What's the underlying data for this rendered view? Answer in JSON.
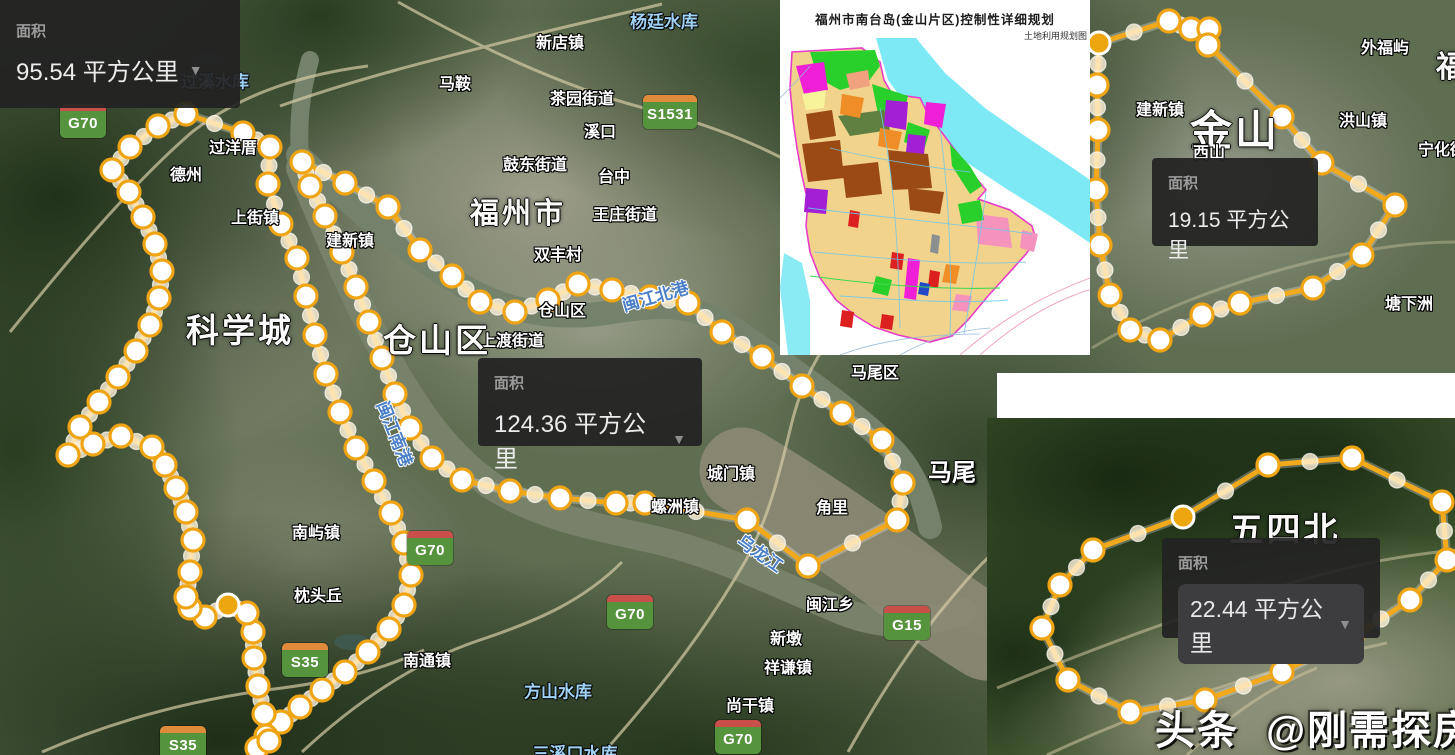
{
  "panels": {
    "p1": {
      "label": "面积",
      "value": "95.54 平方公里",
      "caret": "▼"
    },
    "p2": {
      "label": "面积",
      "value": "124.36 平方公里",
      "caret": "▼"
    },
    "p3": {
      "label": "面积",
      "value": "19.15 平方公里"
    },
    "p4": {
      "label": "面积",
      "value": "22.44 平方公里",
      "caret": "▼"
    }
  },
  "plan_inset": {
    "title": "福州市南台岛(金山片区)控制性详细规划",
    "subtitle": "土地利用规划图"
  },
  "watermark": {
    "brand": "头条",
    "handle": "@刚需探房"
  },
  "badges": [
    {
      "code": "G70",
      "k": "g",
      "x": 60,
      "y": 104
    },
    {
      "code": "S1531",
      "k": "s",
      "x": 643,
      "y": 95,
      "w": 54
    },
    {
      "code": "G70",
      "k": "g",
      "x": 407,
      "y": 531
    },
    {
      "code": "G70",
      "k": "g",
      "x": 607,
      "y": 595
    },
    {
      "code": "S35",
      "k": "s",
      "x": 282,
      "y": 643
    },
    {
      "code": "G15",
      "k": "g",
      "x": 884,
      "y": 606
    },
    {
      "code": "G70",
      "k": "g",
      "x": 715,
      "y": 720
    },
    {
      "code": "S35",
      "k": "s",
      "x": 160,
      "y": 726
    }
  ],
  "labels": [
    {
      "t": "新店镇",
      "x": 560,
      "y": 41,
      "c": "town"
    },
    {
      "t": "马鞍",
      "x": 455,
      "y": 82,
      "c": "town"
    },
    {
      "t": "茶园街道",
      "x": 582,
      "y": 97,
      "c": "town"
    },
    {
      "t": "溪口",
      "x": 600,
      "y": 130,
      "c": "town"
    },
    {
      "t": "鼓东街道",
      "x": 535,
      "y": 163,
      "c": "town"
    },
    {
      "t": "台中",
      "x": 614,
      "y": 175,
      "c": "town"
    },
    {
      "t": "福州市",
      "x": 518,
      "y": 211,
      "c": "big",
      "fs": 29
    },
    {
      "t": "王庄街道",
      "x": 625,
      "y": 213,
      "c": "town"
    },
    {
      "t": "双丰村",
      "x": 558,
      "y": 253,
      "c": "town"
    },
    {
      "t": "仓山区",
      "x": 562,
      "y": 309,
      "c": "town"
    },
    {
      "t": "上渡街道",
      "x": 512,
      "y": 339,
      "c": "town"
    },
    {
      "t": "仓山区",
      "x": 437,
      "y": 338,
      "c": "big",
      "fs": 33
    },
    {
      "t": "科学城",
      "x": 240,
      "y": 328,
      "c": "big",
      "fs": 33
    },
    {
      "t": "过洋厝",
      "x": 233,
      "y": 146,
      "c": "town"
    },
    {
      "t": "德州",
      "x": 186,
      "y": 173,
      "c": "town"
    },
    {
      "t": "上街镇",
      "x": 255,
      "y": 216,
      "c": "town"
    },
    {
      "t": "建新镇",
      "x": 350,
      "y": 239,
      "c": "town"
    },
    {
      "t": "城门镇",
      "x": 731,
      "y": 472,
      "c": "town"
    },
    {
      "t": "螺洲镇",
      "x": 675,
      "y": 505,
      "c": "town"
    },
    {
      "t": "角里",
      "x": 832,
      "y": 506,
      "c": "town"
    },
    {
      "t": "闽江乡",
      "x": 830,
      "y": 603,
      "c": "town"
    },
    {
      "t": "新墩",
      "x": 786,
      "y": 637,
      "c": "town"
    },
    {
      "t": "祥谦镇",
      "x": 788,
      "y": 666,
      "c": "town"
    },
    {
      "t": "尚干镇",
      "x": 750,
      "y": 704,
      "c": "town"
    },
    {
      "t": "南屿镇",
      "x": 316,
      "y": 531,
      "c": "town"
    },
    {
      "t": "枕头丘",
      "x": 318,
      "y": 594,
      "c": "town"
    },
    {
      "t": "南通镇",
      "x": 427,
      "y": 659,
      "c": "town"
    },
    {
      "t": "马尾区",
      "x": 875,
      "y": 371,
      "c": "town"
    },
    {
      "t": "马尾",
      "x": 952,
      "y": 470,
      "c": "mid"
    },
    {
      "t": "外福屿",
      "x": 1385,
      "y": 46,
      "c": "town"
    },
    {
      "t": "福州",
      "x": 1436,
      "y": 64,
      "c": "big",
      "fs": 30,
      "a": "left"
    },
    {
      "t": "建新镇",
      "x": 1160,
      "y": 108,
      "c": "town"
    },
    {
      "t": "金山",
      "x": 1235,
      "y": 128,
      "c": "big",
      "fs": 42
    },
    {
      "t": "西山",
      "x": 1209,
      "y": 151,
      "c": "town"
    },
    {
      "t": "洪山镇",
      "x": 1363,
      "y": 119,
      "c": "town"
    },
    {
      "t": "宁化街道",
      "x": 1418,
      "y": 148,
      "c": "town",
      "a": "left"
    },
    {
      "t": "塘下洲",
      "x": 1409,
      "y": 302,
      "c": "town"
    },
    {
      "t": "五四北",
      "x": 1285,
      "y": 527,
      "c": "big",
      "fs": 34
    },
    {
      "t": "过溪水库",
      "x": 215,
      "y": 80,
      "c": "water"
    },
    {
      "t": "杨廷水库",
      "x": 664,
      "y": 20,
      "c": "water"
    },
    {
      "t": "方山水库",
      "x": 558,
      "y": 690,
      "c": "water"
    },
    {
      "t": "三溪口水库",
      "x": 575,
      "y": 752,
      "c": "water"
    },
    {
      "t": "闽江北港",
      "x": 655,
      "y": 295,
      "c": "river",
      "r": -16
    },
    {
      "t": "闽江南港",
      "x": 396,
      "y": 433,
      "c": "river",
      "r": 68
    },
    {
      "t": "乌龙江",
      "x": 761,
      "y": 552,
      "c": "river",
      "r": 35
    }
  ],
  "polygons": [
    {
      "name": "科学城片区",
      "area": "95.54 平方公里",
      "solid": [
        30
      ],
      "points": [
        [
          186,
          114
        ],
        [
          243,
          133
        ],
        [
          270,
          147
        ],
        [
          268,
          184
        ],
        [
          281,
          224
        ],
        [
          297,
          258
        ],
        [
          306,
          296
        ],
        [
          315,
          335
        ],
        [
          326,
          374
        ],
        [
          340,
          412
        ],
        [
          356,
          448
        ],
        [
          374,
          481
        ],
        [
          391,
          513
        ],
        [
          404,
          543
        ],
        [
          411,
          575
        ],
        [
          404,
          605
        ],
        [
          389,
          629
        ],
        [
          368,
          652
        ],
        [
          345,
          672
        ],
        [
          322,
          690
        ],
        [
          300,
          707
        ],
        [
          281,
          722
        ],
        [
          266,
          736
        ],
        [
          257,
          748
        ],
        [
          269,
          741
        ],
        [
          264,
          714
        ],
        [
          258,
          686
        ],
        [
          254,
          658
        ],
        [
          253,
          632
        ],
        [
          247,
          613
        ],
        [
          228,
          605
        ],
        [
          205,
          617
        ],
        [
          190,
          608
        ],
        [
          186,
          597
        ],
        [
          190,
          572
        ],
        [
          193,
          540
        ],
        [
          186,
          512
        ],
        [
          176,
          488
        ],
        [
          165,
          465
        ],
        [
          152,
          447
        ],
        [
          121,
          436
        ],
        [
          93,
          444
        ],
        [
          68,
          455
        ],
        [
          80,
          427
        ],
        [
          99,
          402
        ],
        [
          118,
          377
        ],
        [
          136,
          351
        ],
        [
          150,
          325
        ],
        [
          159,
          298
        ],
        [
          162,
          271
        ],
        [
          155,
          244
        ],
        [
          143,
          217
        ],
        [
          129,
          192
        ],
        [
          112,
          170
        ],
        [
          130,
          147
        ],
        [
          158,
          126
        ]
      ]
    },
    {
      "name": "仓山区片区",
      "area": "124.36 平方公里",
      "solid": [],
      "points": [
        [
          302,
          162
        ],
        [
          345,
          183
        ],
        [
          388,
          207
        ],
        [
          420,
          250
        ],
        [
          452,
          276
        ],
        [
          480,
          302
        ],
        [
          515,
          312
        ],
        [
          548,
          300
        ],
        [
          578,
          284
        ],
        [
          612,
          290
        ],
        [
          650,
          297
        ],
        [
          688,
          303
        ],
        [
          722,
          332
        ],
        [
          762,
          357
        ],
        [
          802,
          386
        ],
        [
          842,
          413
        ],
        [
          882,
          440
        ],
        [
          903,
          483
        ],
        [
          897,
          520
        ],
        [
          808,
          566
        ],
        [
          747,
          520
        ],
        [
          645,
          503
        ],
        [
          616,
          503
        ],
        [
          560,
          498
        ],
        [
          510,
          491
        ],
        [
          462,
          480
        ],
        [
          432,
          458
        ],
        [
          410,
          428
        ],
        [
          395,
          394
        ],
        [
          382,
          358
        ],
        [
          369,
          322
        ],
        [
          356,
          287
        ],
        [
          342,
          252
        ],
        [
          325,
          216
        ],
        [
          310,
          186
        ]
      ]
    },
    {
      "name": "金山片区",
      "area": "19.15 平方公里",
      "solid": [
        0
      ],
      "points": [
        [
          1099,
          43
        ],
        [
          1169,
          21
        ],
        [
          1191,
          29
        ],
        [
          1209,
          29
        ],
        [
          1208,
          45
        ],
        [
          1282,
          117
        ],
        [
          1322,
          163
        ],
        [
          1395,
          205
        ],
        [
          1362,
          255
        ],
        [
          1313,
          288
        ],
        [
          1240,
          303
        ],
        [
          1202,
          315
        ],
        [
          1160,
          340
        ],
        [
          1130,
          330
        ],
        [
          1110,
          295
        ],
        [
          1100,
          245
        ],
        [
          1096,
          190
        ],
        [
          1098,
          130
        ],
        [
          1097,
          85
        ]
      ]
    },
    {
      "name": "五四北片区",
      "area": "22.44 平方公里",
      "solid": [
        1
      ],
      "points": [
        [
          1093,
          550
        ],
        [
          1183,
          517
        ],
        [
          1268,
          465
        ],
        [
          1352,
          458
        ],
        [
          1442,
          502
        ],
        [
          1447,
          560
        ],
        [
          1410,
          600
        ],
        [
          1352,
          638
        ],
        [
          1282,
          672
        ],
        [
          1205,
          700
        ],
        [
          1130,
          712
        ],
        [
          1068,
          680
        ],
        [
          1042,
          628
        ],
        [
          1060,
          585
        ]
      ]
    }
  ],
  "colors": {
    "polygon_line": "#f2a91c",
    "vertex_fill": "#ffffff",
    "vertex_ring": "#efa413",
    "panel_bg": "#222222",
    "badge_green": "#55933d",
    "badge_red_strip": "#c9504a",
    "badge_orange_strip": "#e08a3c",
    "water_label": "#9fd2f5",
    "river_label": "#4a7fc8"
  }
}
